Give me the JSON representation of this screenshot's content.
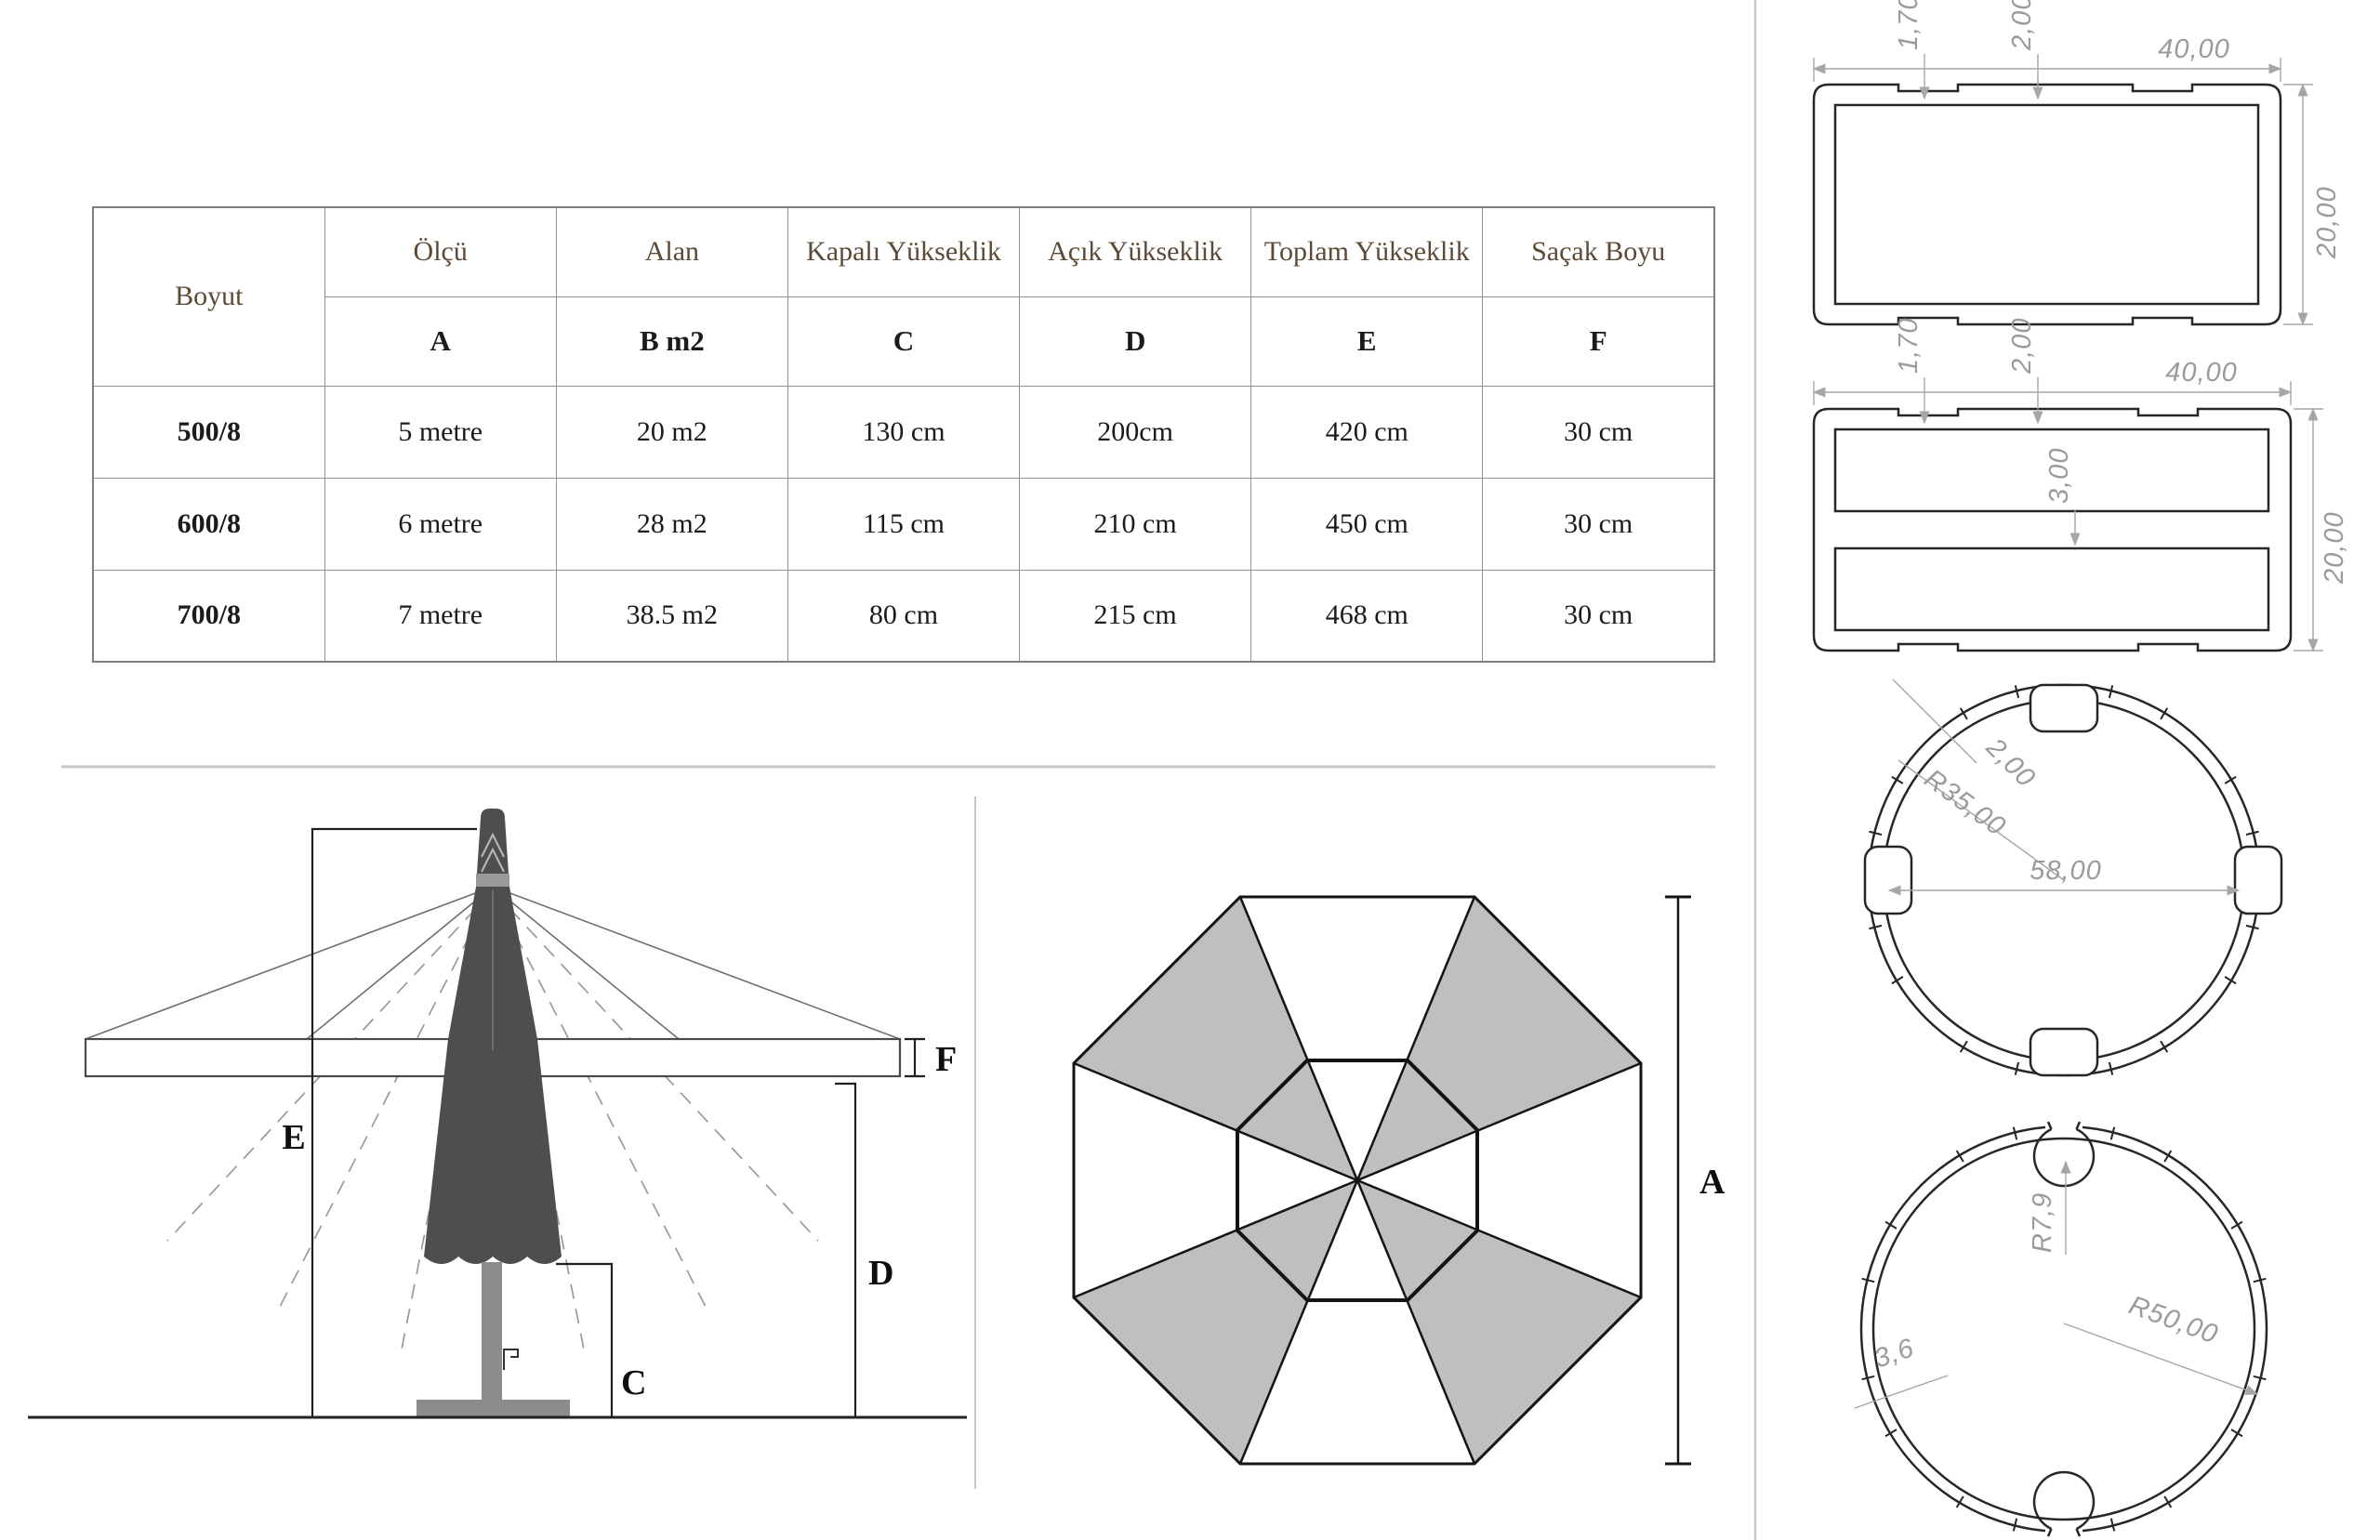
{
  "table": {
    "corner": "Boyut",
    "columns": [
      {
        "name": "Ölçü",
        "letter": "A"
      },
      {
        "name": "Alan",
        "letter": "B m2"
      },
      {
        "name": "Kapalı Yükseklik",
        "letter": "C"
      },
      {
        "name": "Açık Yükseklik",
        "letter": "D"
      },
      {
        "name": "Toplam Yükseklik",
        "letter": "E"
      },
      {
        "name": "Saçak Boyu",
        "letter": "F"
      }
    ],
    "rows": [
      {
        "size": "500/8",
        "values": [
          "5 metre",
          "20 m2",
          "130 cm",
          "200cm",
          "420 cm",
          "30 cm"
        ]
      },
      {
        "size": "600/8",
        "values": [
          "6 metre",
          "28 m2",
          "115 cm",
          "210 cm",
          "450 cm",
          "30 cm"
        ]
      },
      {
        "size": "700/8",
        "values": [
          "7 metre",
          "38.5 m2",
          "80 cm",
          "215 cm",
          "468 cm",
          "30 cm"
        ]
      }
    ]
  },
  "side_view": {
    "label_e": "E",
    "label_f": "F",
    "label_d": "D",
    "label_c": "C"
  },
  "top_view": {
    "label_a": "A"
  },
  "profiles": {
    "rect1": {
      "lip": "1,70",
      "groove": "2,00",
      "width": "40,00",
      "height": "20,00"
    },
    "rect2": {
      "lip": "1,70",
      "groove": "2,00",
      "width": "40,00",
      "web": "3,00",
      "height": "20,00"
    },
    "ring": {
      "wall": "2,00",
      "radius": "R35,00",
      "inner_diameter": "58,00"
    },
    "tube": {
      "channel_radius": "R7,9",
      "outer_radius": "R50,00",
      "wall": "3,6"
    }
  },
  "colors": {
    "header_text": "#5d4a36",
    "table_border": "#8f8f8f",
    "canopy_dark": "#4e4e4e",
    "metal_gray": "#8c8c8c",
    "panel_gray": "#bfbfbf",
    "dim_gray": "#9b9b9b",
    "separator": "#c9c7c3"
  }
}
